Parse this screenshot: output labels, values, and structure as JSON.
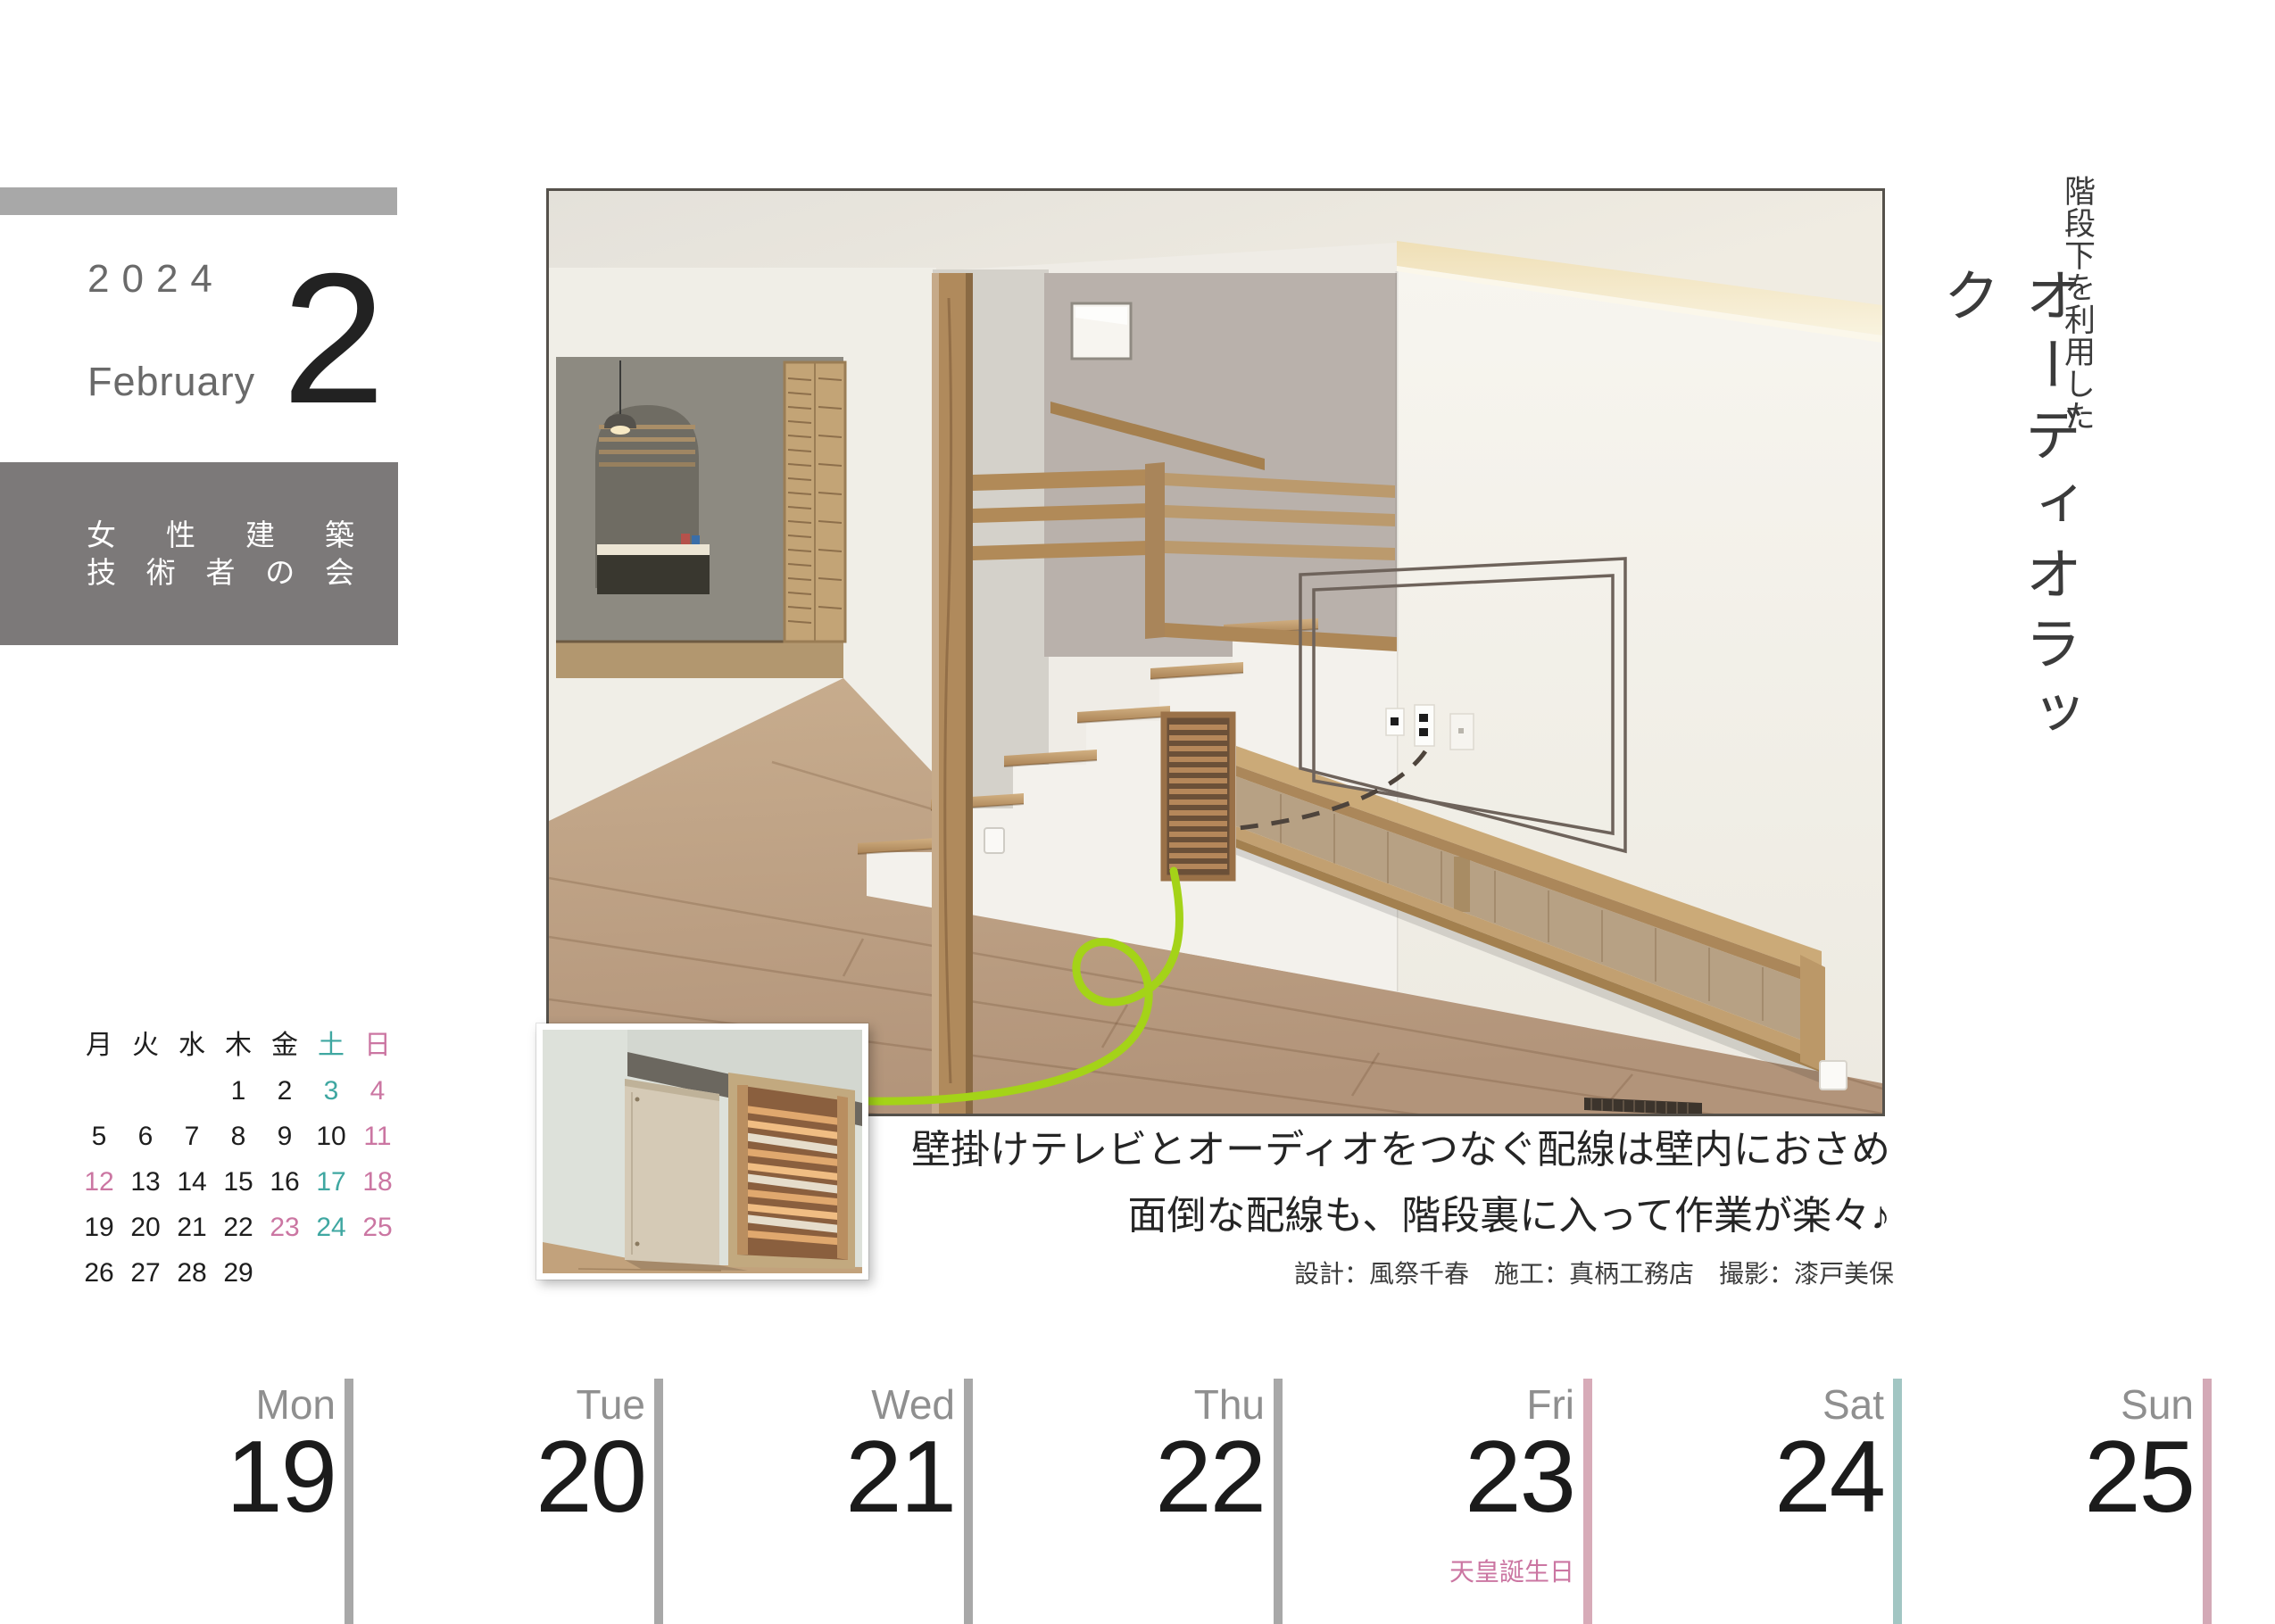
{
  "page": {
    "year": "2024",
    "month_name": "February",
    "month_number": "2"
  },
  "org_box": {
    "line1": "女性建築",
    "line2": "技術者の会"
  },
  "mini_calendar": {
    "weekday_headers": [
      {
        "label": "月",
        "type": "wd"
      },
      {
        "label": "火",
        "type": "wd"
      },
      {
        "label": "水",
        "type": "wd"
      },
      {
        "label": "木",
        "type": "wd"
      },
      {
        "label": "金",
        "type": "wd"
      },
      {
        "label": "土",
        "type": "sat"
      },
      {
        "label": "日",
        "type": "sun"
      }
    ],
    "cells": [
      {
        "d": "",
        "t": "none"
      },
      {
        "d": "",
        "t": "none"
      },
      {
        "d": "",
        "t": "none"
      },
      {
        "d": "1",
        "t": "wd"
      },
      {
        "d": "2",
        "t": "wd"
      },
      {
        "d": "3",
        "t": "sat"
      },
      {
        "d": "4",
        "t": "sun"
      },
      {
        "d": "5",
        "t": "wd"
      },
      {
        "d": "6",
        "t": "wd"
      },
      {
        "d": "7",
        "t": "wd"
      },
      {
        "d": "8",
        "t": "wd"
      },
      {
        "d": "9",
        "t": "wd"
      },
      {
        "d": "10",
        "t": "wd"
      },
      {
        "d": "11",
        "t": "sun"
      },
      {
        "d": "12",
        "t": "holiday"
      },
      {
        "d": "13",
        "t": "wd"
      },
      {
        "d": "14",
        "t": "wd"
      },
      {
        "d": "15",
        "t": "wd"
      },
      {
        "d": "16",
        "t": "wd"
      },
      {
        "d": "17",
        "t": "sat"
      },
      {
        "d": "18",
        "t": "sun"
      },
      {
        "d": "19",
        "t": "wd"
      },
      {
        "d": "20",
        "t": "wd"
      },
      {
        "d": "21",
        "t": "wd"
      },
      {
        "d": "22",
        "t": "wd"
      },
      {
        "d": "23",
        "t": "holiday"
      },
      {
        "d": "24",
        "t": "sat"
      },
      {
        "d": "25",
        "t": "sun"
      },
      {
        "d": "26",
        "t": "wd"
      },
      {
        "d": "27",
        "t": "wd"
      },
      {
        "d": "28",
        "t": "wd"
      },
      {
        "d": "29",
        "t": "wd"
      },
      {
        "d": "",
        "t": "none"
      },
      {
        "d": "",
        "t": "none"
      },
      {
        "d": "",
        "t": "none"
      }
    ]
  },
  "feature": {
    "title_vertical_small": "階段下を利用した",
    "title_vertical_large": "オーディオラック",
    "caption_line1": "壁掛けテレビとオーディオをつなぐ配線は壁内におさめ",
    "caption_line2": "面倒な配線も、階段裏に入って作業が楽々♪",
    "credits": "設計：風祭千春　施工：真柄工務店　撮影：漆戸美保"
  },
  "week_strip": {
    "days": [
      {
        "dow": "Mon",
        "date": "19",
        "type": "wd"
      },
      {
        "dow": "Tue",
        "date": "20",
        "type": "wd"
      },
      {
        "dow": "Wed",
        "date": "21",
        "type": "wd"
      },
      {
        "dow": "Thu",
        "date": "22",
        "type": "wd"
      },
      {
        "dow": "Fri",
        "date": "23",
        "type": "holiday",
        "holiday": "天皇誕生日"
      },
      {
        "dow": "Sat",
        "date": "24",
        "type": "sat"
      },
      {
        "dow": "Sun",
        "date": "25",
        "type": "sun"
      }
    ]
  },
  "colors": {
    "accent_teal": "#3fa7a1",
    "accent_pink": "#cb76a2",
    "bar_gray": "#a8a8a8",
    "bar_pink": "#d7abb8",
    "bar_teal": "#a2c6c3",
    "org_box_gray": "#7c7979",
    "cable_green": "#a4d318"
  }
}
